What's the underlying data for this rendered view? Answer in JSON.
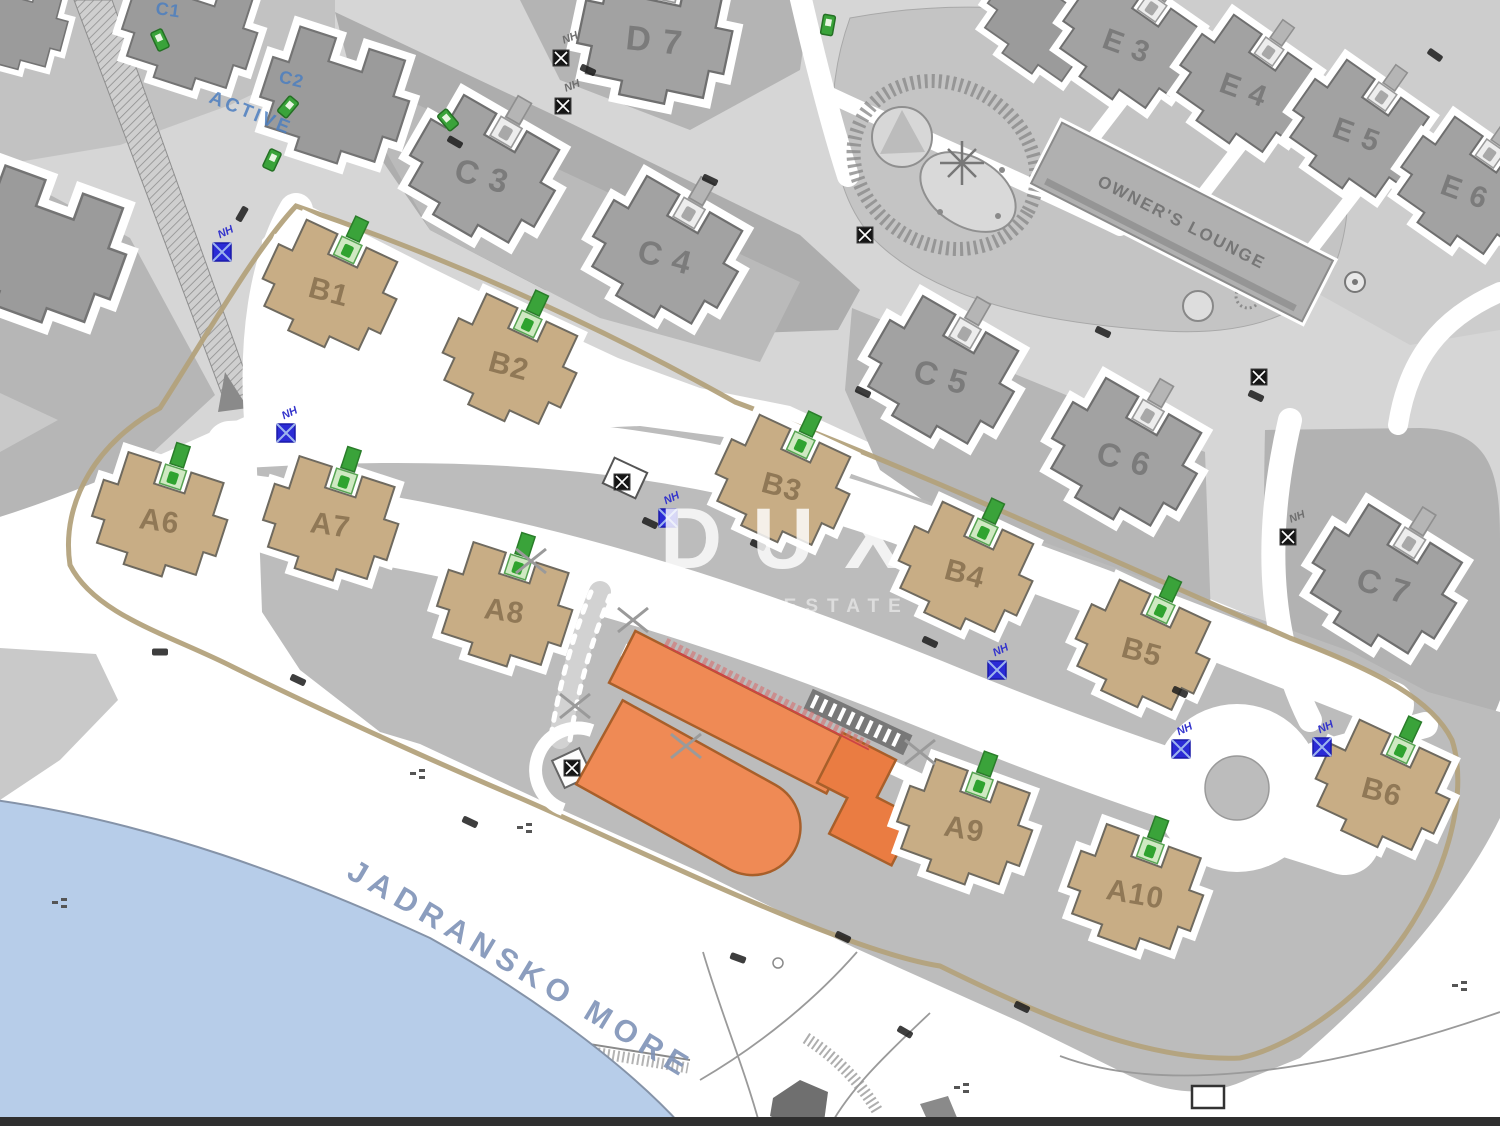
{
  "map": {
    "watermark": {
      "title": "DUX",
      "subtitle": "REAL ESTATE"
    },
    "sea_label": "JADRANSKO MORE",
    "owners_lounge_label": "OWNER'S LOUNGE",
    "nh_label": "NH",
    "colors": {
      "sea": "#b7cde9",
      "ground_light": "#d6d6d6",
      "ground_medium": "#b9b9b9",
      "building_tan": "#c8ad85",
      "building_gray": "#a2a2a2",
      "building_orange": "#ef8a55",
      "loop_path_tan": "#b3a27c",
      "marker_green": "#3aa33a",
      "marker_blue": "#2b2bd6",
      "label_blue": "#4d7fc0"
    },
    "blue_labels": [
      {
        "text": "C1",
        "x": 155,
        "y": 14,
        "rot": 8,
        "size": 18,
        "spacing": 1
      },
      {
        "text": "C2",
        "x": 278,
        "y": 82,
        "rot": 14,
        "size": 18,
        "spacing": 1
      },
      {
        "text": "ACTIVE",
        "x": 208,
        "y": 102,
        "rot": 22,
        "size": 19,
        "spacing": 3
      }
    ],
    "buildings": [
      {
        "id": "x1",
        "label": "",
        "x": 190,
        "y": 30,
        "rot": 18,
        "s": 1.0,
        "type": "gray2"
      },
      {
        "id": "x2",
        "label": "",
        "x": 335,
        "y": 98,
        "rot": 18,
        "s": 1.1,
        "type": "gray2"
      },
      {
        "id": "x3",
        "label": "",
        "x": 42,
        "y": 248,
        "rot": 20,
        "s": 1.25,
        "type": "gray2"
      },
      {
        "id": "x4",
        "label": "",
        "x": 14,
        "y": 22,
        "rot": 15,
        "s": 0.8,
        "type": "gray2"
      },
      {
        "id": "x5",
        "label": "",
        "x": 1046,
        "y": 22,
        "rot": 35,
        "s": 0.9,
        "type": "gray2"
      },
      {
        "id": "D7",
        "label": "D 7",
        "x": 655,
        "y": 36,
        "rot": 12,
        "s": 1.15,
        "type": "gray",
        "lr": -6
      },
      {
        "id": "C3",
        "label": "C 3",
        "x": 483,
        "y": 172,
        "rot": 30,
        "s": 1.1,
        "type": "gray",
        "lr": -15
      },
      {
        "id": "C4",
        "label": "C 4",
        "x": 666,
        "y": 253,
        "rot": 30,
        "s": 1.1,
        "type": "gray",
        "lr": -15
      },
      {
        "id": "C5",
        "label": "C 5",
        "x": 942,
        "y": 373,
        "rot": 30,
        "s": 1.1,
        "type": "gray",
        "lr": -15
      },
      {
        "id": "C6",
        "label": "C 6",
        "x": 1125,
        "y": 455,
        "rot": 30,
        "s": 1.1,
        "type": "gray",
        "lr": -15
      },
      {
        "id": "C7",
        "label": "C 7",
        "x": 1385,
        "y": 582,
        "rot": 32,
        "s": 1.1,
        "type": "gray",
        "lr": -15
      },
      {
        "id": "E3",
        "label": "E 3",
        "x": 1128,
        "y": 42,
        "rot": 35,
        "s": 1.0,
        "type": "gray",
        "lr": -15
      },
      {
        "id": "E4",
        "label": "E 4",
        "x": 1245,
        "y": 86,
        "rot": 35,
        "s": 1.0,
        "type": "gray",
        "lr": -15
      },
      {
        "id": "E5",
        "label": "E 5",
        "x": 1358,
        "y": 131,
        "rot": 35,
        "s": 1.0,
        "type": "gray",
        "lr": -15
      },
      {
        "id": "E6",
        "label": "E 6",
        "x": 1466,
        "y": 188,
        "rot": 35,
        "s": 1.0,
        "type": "gray",
        "lr": -15
      },
      {
        "id": "B1",
        "label": "B1",
        "x": 330,
        "y": 288,
        "rot": 25,
        "s": 1.0,
        "type": "tan"
      },
      {
        "id": "B2",
        "label": "B2",
        "x": 510,
        "y": 362,
        "rot": 25,
        "s": 1.0,
        "type": "tan"
      },
      {
        "id": "B3",
        "label": "B3",
        "x": 783,
        "y": 483,
        "rot": 25,
        "s": 1.0,
        "type": "tan"
      },
      {
        "id": "B4",
        "label": "B4",
        "x": 966,
        "y": 570,
        "rot": 25,
        "s": 1.0,
        "type": "tan"
      },
      {
        "id": "B5",
        "label": "B5",
        "x": 1143,
        "y": 648,
        "rot": 25,
        "s": 1.0,
        "type": "tan"
      },
      {
        "id": "B6",
        "label": "B6",
        "x": 1383,
        "y": 788,
        "rot": 25,
        "s": 1.0,
        "type": "tan"
      },
      {
        "id": "A6",
        "label": "A6",
        "x": 160,
        "y": 517,
        "rot": 18,
        "s": 1.0,
        "type": "tan"
      },
      {
        "id": "A7",
        "label": "A7",
        "x": 331,
        "y": 521,
        "rot": 18,
        "s": 1.0,
        "type": "tan"
      },
      {
        "id": "A8",
        "label": "A8",
        "x": 505,
        "y": 607,
        "rot": 18,
        "s": 1.0,
        "type": "tan"
      },
      {
        "id": "A9",
        "label": "A9",
        "x": 965,
        "y": 825,
        "rot": 20,
        "s": 1.0,
        "type": "tan"
      },
      {
        "id": "A10",
        "label": "A10",
        "x": 1136,
        "y": 890,
        "rot": 20,
        "s": 1.0,
        "type": "tan"
      }
    ],
    "markers": {
      "nh_blue": [
        {
          "x": 222,
          "y": 252
        },
        {
          "x": 286,
          "y": 433
        },
        {
          "x": 668,
          "y": 518
        },
        {
          "x": 997,
          "y": 670
        },
        {
          "x": 1181,
          "y": 749
        },
        {
          "x": 1322,
          "y": 747
        }
      ],
      "nh_black": [
        {
          "x": 561,
          "y": 58,
          "nh": true
        },
        {
          "x": 563,
          "y": 106,
          "nh": true
        },
        {
          "x": 865,
          "y": 235,
          "nh": false
        },
        {
          "x": 1259,
          "y": 377,
          "nh": false
        },
        {
          "x": 1288,
          "y": 537,
          "nh": true
        },
        {
          "x": 622,
          "y": 482,
          "nh": false
        },
        {
          "x": 572,
          "y": 768,
          "nh": false
        }
      ],
      "green_path": [
        {
          "x": 160,
          "y": 40,
          "r": -25
        },
        {
          "x": 288,
          "y": 107,
          "r": 40
        },
        {
          "x": 272,
          "y": 160,
          "r": 25
        },
        {
          "x": 828,
          "y": 25,
          "r": 10
        },
        {
          "x": 448,
          "y": 120,
          "r": -40
        }
      ],
      "cars": [
        [
          455,
          142,
          30
        ],
        [
          242,
          214,
          -60
        ],
        [
          650,
          523,
          25
        ],
        [
          758,
          545,
          25
        ],
        [
          930,
          642,
          25
        ],
        [
          1180,
          692,
          25
        ],
        [
          470,
          822,
          25
        ],
        [
          843,
          937,
          25
        ],
        [
          1022,
          1007,
          25
        ],
        [
          160,
          652,
          0
        ],
        [
          863,
          392,
          25
        ],
        [
          1103,
          332,
          25
        ],
        [
          1256,
          396,
          25
        ],
        [
          710,
          180,
          25
        ],
        [
          588,
          70,
          25
        ],
        [
          1435,
          55,
          35
        ],
        [
          298,
          680,
          25
        ],
        [
          905,
          1032,
          30
        ],
        [
          738,
          958,
          20
        ]
      ],
      "crosses": [
        [
          633,
          620
        ],
        [
          686,
          746
        ],
        [
          531,
          561
        ],
        [
          575,
          706
        ],
        [
          920,
          752
        ]
      ],
      "benches": [
        [
          418,
          776
        ],
        [
          525,
          830
        ],
        [
          1460,
          988
        ],
        [
          962,
          1090
        ],
        [
          60,
          905
        ]
      ]
    }
  }
}
